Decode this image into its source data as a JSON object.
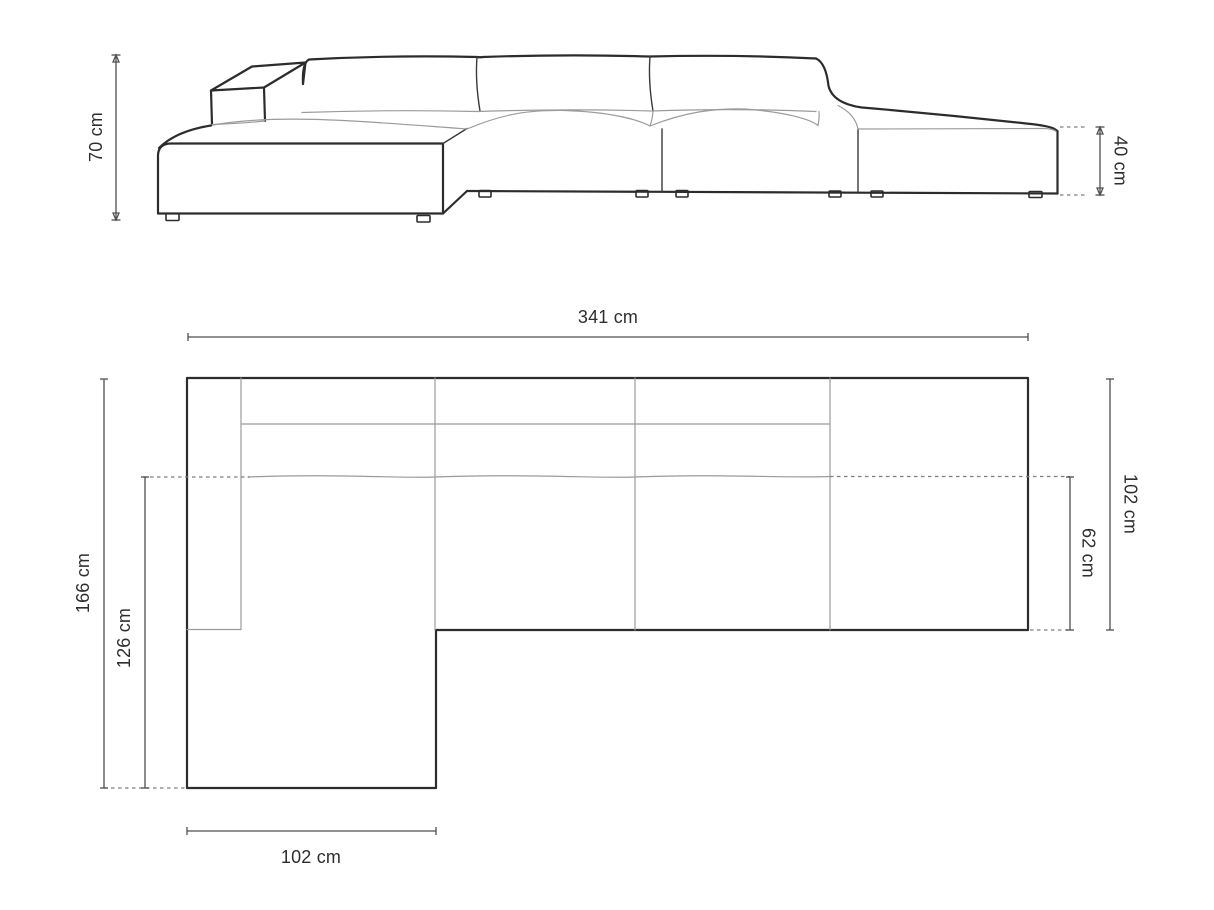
{
  "diagram": {
    "title": "sectional-sofa-dimension-drawing",
    "colors": {
      "background": "#ffffff",
      "outline_dark": "#2c2c2c",
      "line_light": "#9b9b9b",
      "dimension_line": "#4f4f4f",
      "text": "#2e2e2e"
    },
    "front_view": {
      "labels": {
        "total_height": "70 cm",
        "seat_height": "40 cm"
      }
    },
    "top_view": {
      "labels": {
        "total_width": "341 cm",
        "total_depth": "166 cm",
        "chaise_length": "126 cm",
        "chaise_width": "102 cm",
        "body_depth": "102 cm",
        "seat_depth": "62 cm"
      }
    }
  }
}
